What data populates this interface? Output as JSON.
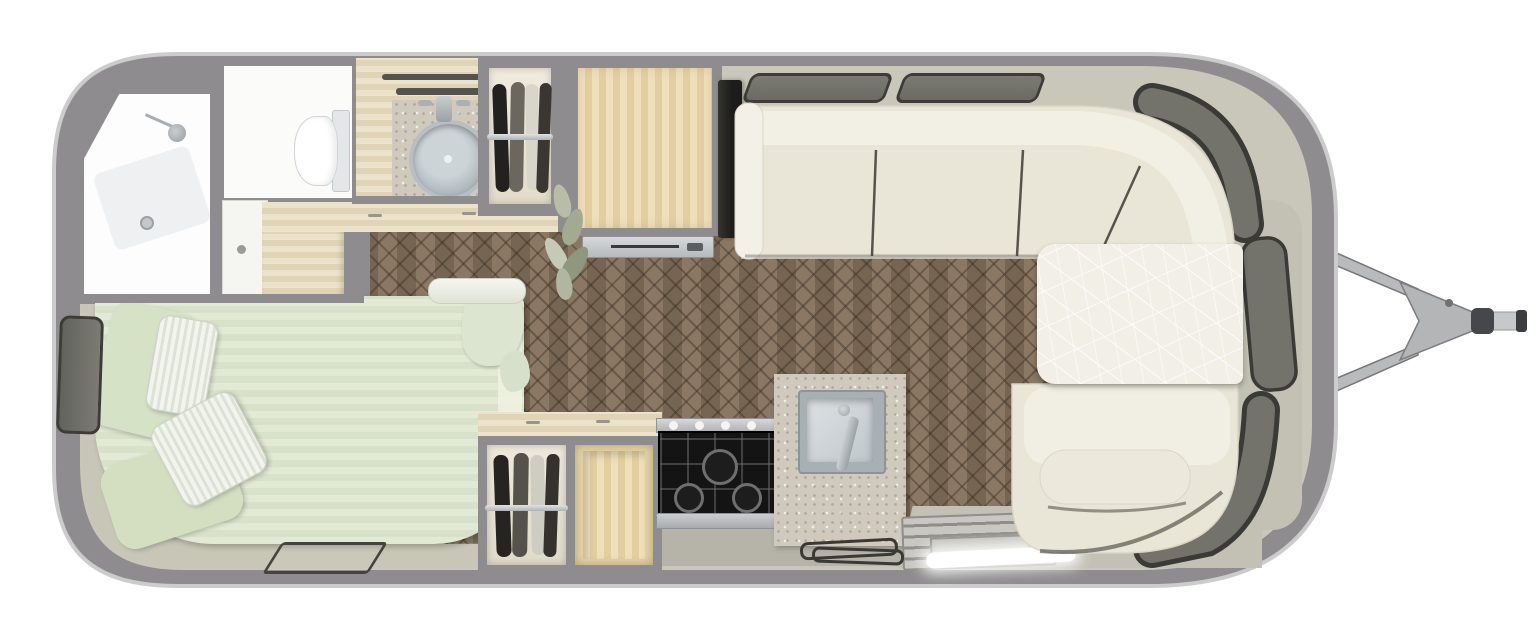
{
  "scene": {
    "type": "travel-trailer floor plan, top-down 3D render",
    "background_color": "#ffffff",
    "visible_text": "none"
  },
  "colors": {
    "shell": "#8e8c8e",
    "shell_edge": "#cccccc",
    "interior_floor": "#c9c7b9",
    "counter_floor": "#b6b3a9",
    "wood_floor": "#83705b",
    "bed_fabric": "#dfe8d1",
    "pillow_white": "#f1f3ee",
    "pillow_green": "#d6e2c5",
    "sofa_fabric": "#e9e5d7",
    "sofa_back": "#f2efe5",
    "table_top": "#f1efe6",
    "window_glass": "#73736c",
    "window_frame": "#3a3a36",
    "cabinet_wood": "#ecd9ad",
    "vanity_stone": "#d0c9bd",
    "stove_black": "#161616",
    "stainless_steel": "#c7cacc",
    "led_light": "#ffffff",
    "hitch_metal": "#b5b6b8"
  },
  "rooms": {
    "bathroom_front_left": {
      "items": [
        "shower-room",
        "shower-head",
        "toilet-room",
        "toilet",
        "bathroom-door",
        "dresser-counter",
        "vanity-stone-sink",
        "towel-bars",
        "hanging-wardrobe"
      ]
    },
    "bedroom_rear_left": {
      "items": [
        "double-bed",
        "green-pillow x2",
        "white-striped-pillow x2",
        "blanket-ruffle",
        "white-bolster",
        "left-wall-window",
        "floor-mat-outline"
      ]
    },
    "kitchen_center": {
      "items": [
        "refrigerator-cabinet",
        "fridge-vent",
        "lower-wardrobe",
        "open-shelf",
        "stove-3-burner-4-knob",
        "marble-counter",
        "square-sink",
        "faucet",
        "entry-step-grate",
        "entry-led-light",
        "floor-cable-coil"
      ]
    },
    "lounge_front_right": {
      "items": [
        "tv-screen",
        "sofa-3-cushion",
        "sofa-armrest",
        "corner-wrap-cushion",
        "dinette-table",
        "dinette-bench",
        "bench-seat-cushion",
        "decor-plant"
      ]
    },
    "windows": {
      "items": [
        "top-wall-trapezoid-window x2",
        "curved-corner-window-top-right",
        "right-wall-window-upper",
        "right-wall-curved-window-lower",
        "bedroom-left-window"
      ]
    },
    "exterior": {
      "items": [
        "aluminum-shell",
        "a-frame-tongue-bars",
        "tongue-plate",
        "hitch-coupler",
        "tow-bar-tip"
      ]
    }
  }
}
